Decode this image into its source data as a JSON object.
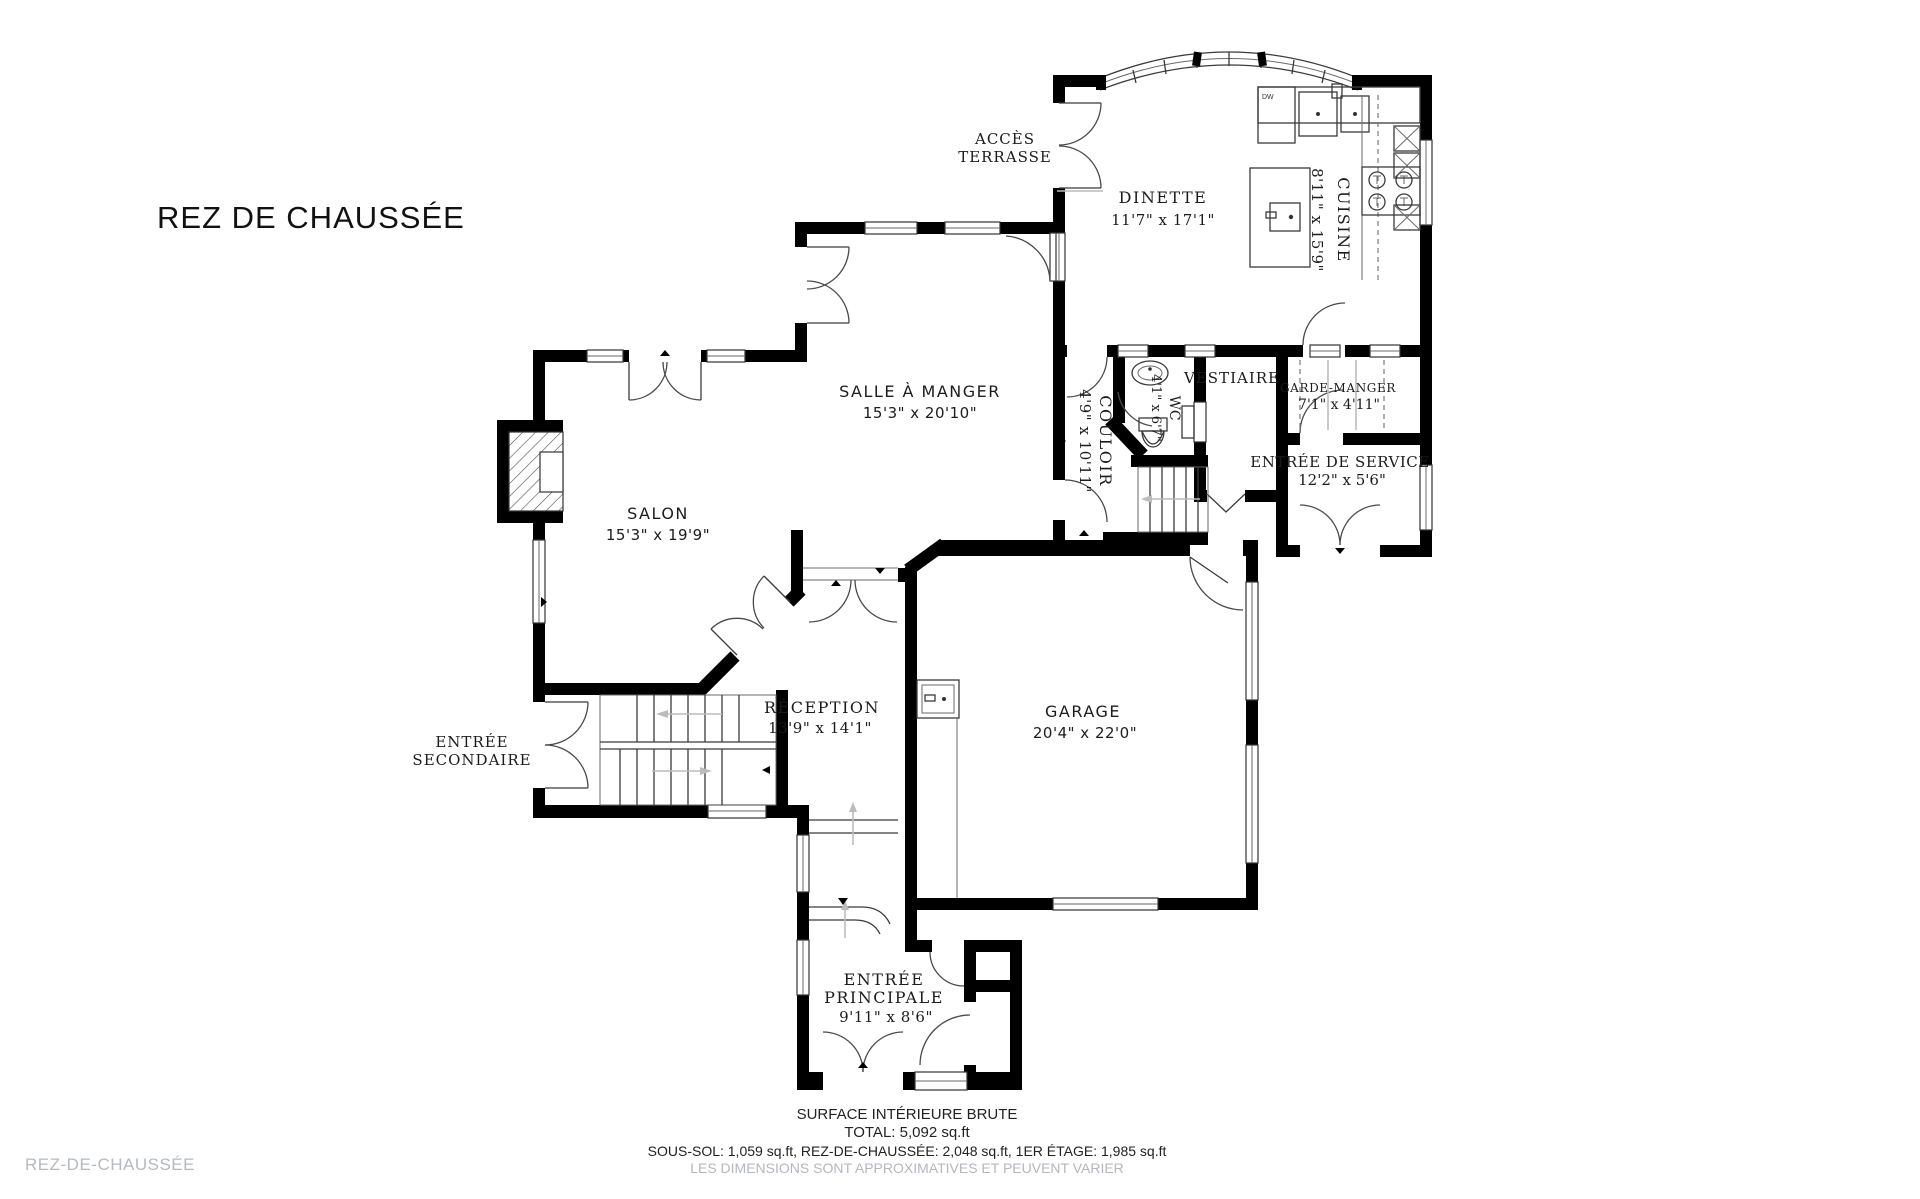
{
  "title": "REZ DE CHAUSSÉE",
  "watermark": "REZ-DE-CHAUSSÉE",
  "footer": {
    "line1": "SURFACE INTÉRIEURE BRUTE",
    "line2": "TOTAL: 5,092 sq.ft",
    "line3": "SOUS-SOL: 1,059 sq.ft, REZ-DE-CHAUSSÉE: 2,048 sq.ft, 1ER ÉTAGE: 1,985 sq.ft",
    "line4": "LES DIMENSIONS SONT APPROXIMATIVES ET PEUVENT VARIER"
  },
  "rooms": {
    "dinette": {
      "name": "DINETTE",
      "dims": "11'7\" x 17'1\""
    },
    "cuisine": {
      "name": "CUISINE",
      "dims": "8'11\" x 15'9\""
    },
    "salle_a_manger": {
      "name": "SALLE À MANGER",
      "dims": "15'3\" x 20'10\""
    },
    "salon": {
      "name": "SALON",
      "dims": "15'3\" x 19'9\""
    },
    "reception": {
      "name": "RÉCEPTION",
      "dims": "13'9\" x 14'1\""
    },
    "garage": {
      "name": "GARAGE",
      "dims": "20'4\" x 22'0\""
    },
    "couloir": {
      "name": "COULOIR",
      "dims": "4'9\" x 10'11\""
    },
    "wc": {
      "name": "WC",
      "dims": "4'1\" x 6'7\""
    },
    "vestiaire": {
      "name": "VESTIAIRE"
    },
    "garde_manger": {
      "name": "GARDE-MANGER",
      "dims": "7'1\" x 4'11\""
    },
    "entree_service": {
      "name": "ENTRÉE DE SERVICE",
      "dims": "12'2\" x 5'6\""
    },
    "entree_principale": {
      "name": "ENTRÉE",
      "name2": "PRINCIPALE",
      "dims": "9'11\" x 8'6\""
    },
    "entree_secondaire": {
      "name": "ENTRÉE",
      "name2": "SECONDAIRE"
    },
    "acces_terrasse": {
      "name": "ACCÈS",
      "name2": "TERRASSE"
    }
  },
  "fixtures": {
    "dishwasher": "DW"
  },
  "colors": {
    "wall": "#000000",
    "line": "#3a3a3a",
    "gray": "#bcbcbc",
    "muted": "#b2b8be"
  }
}
